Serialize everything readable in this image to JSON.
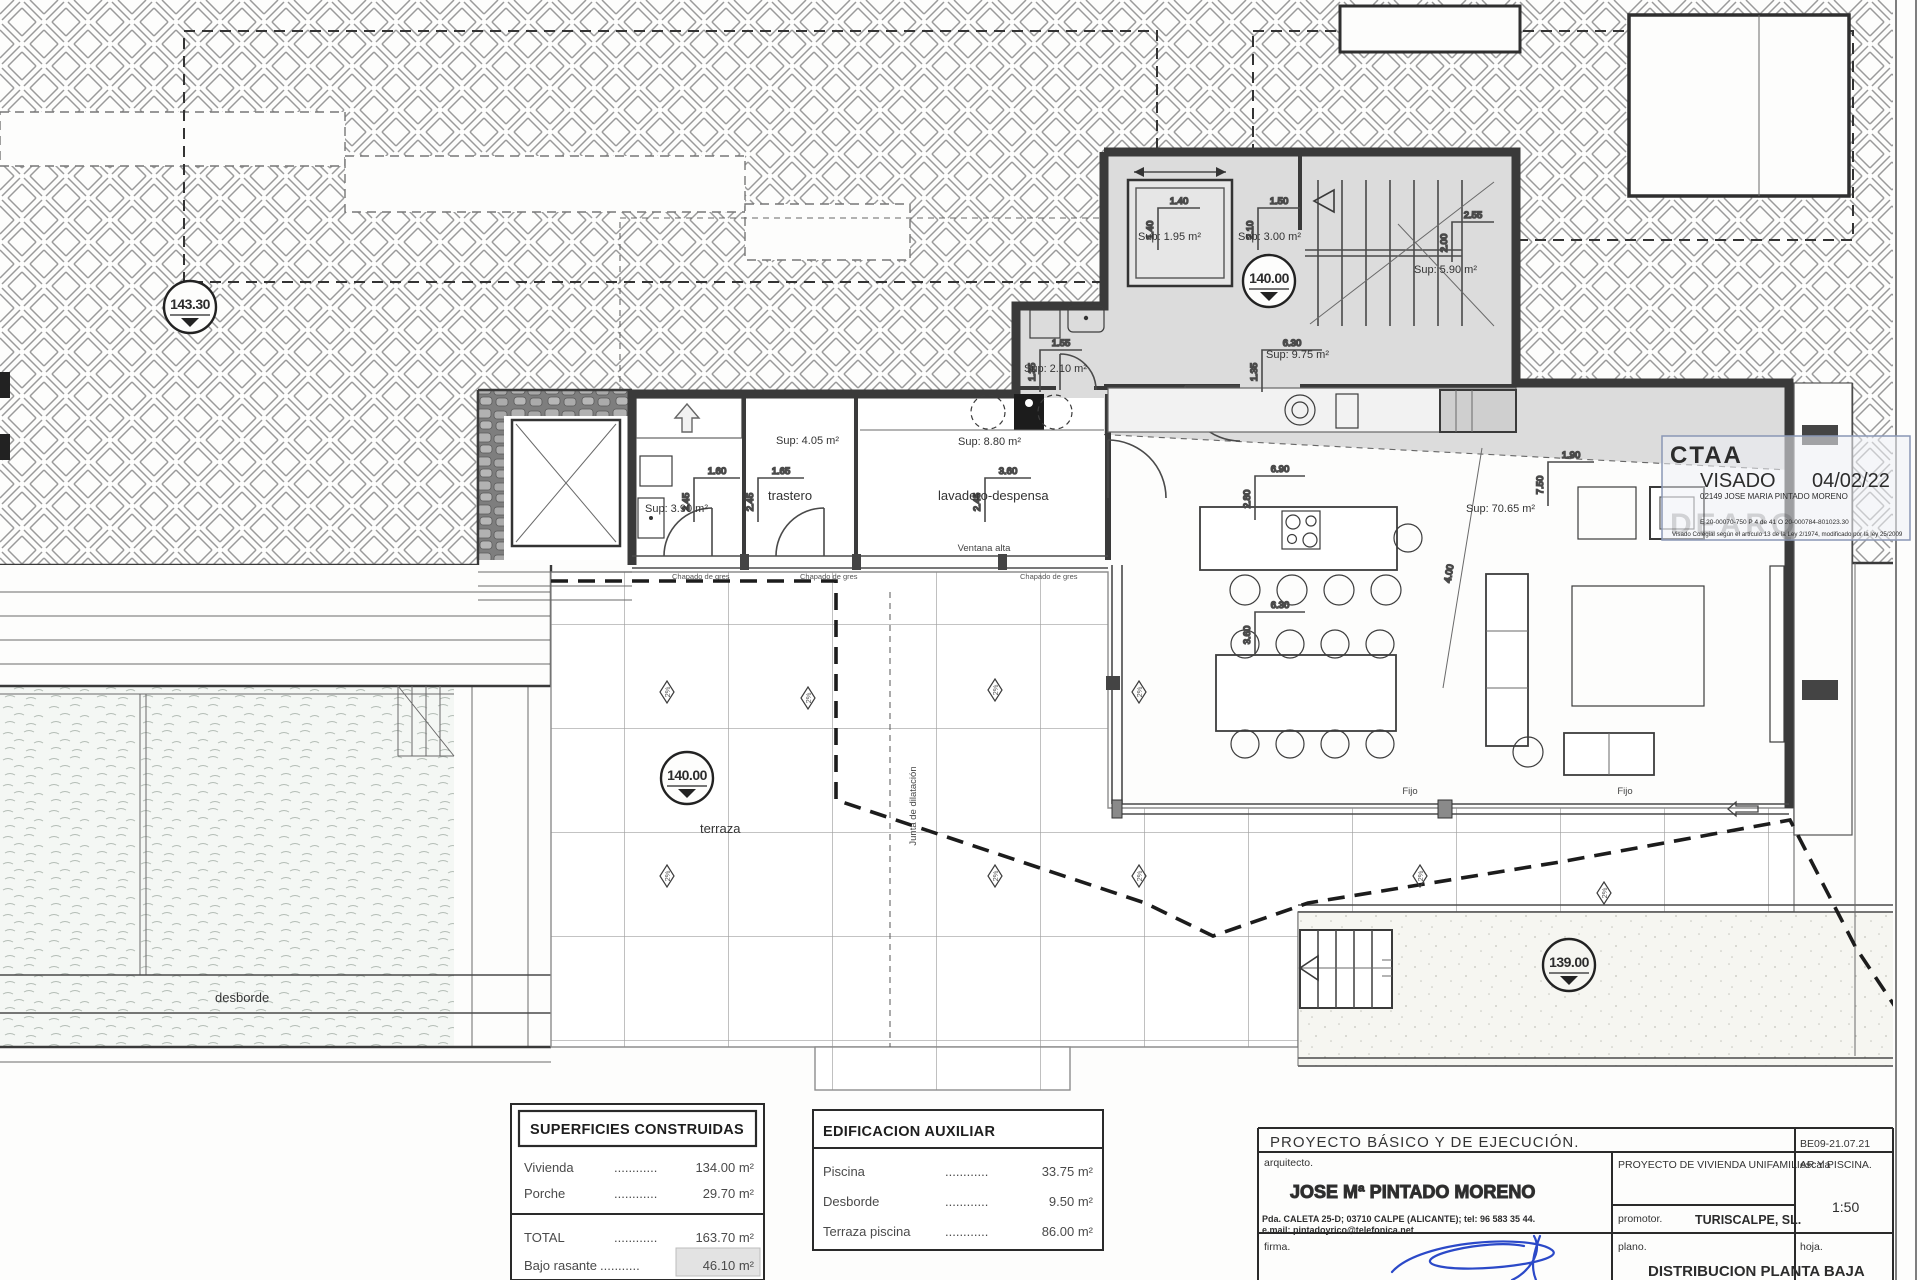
{
  "colors": {
    "accent_blue": "#3a5fa8",
    "signature_blue": "#2b49c8",
    "wall_dark": "#3a3a3a",
    "shade_gray": "#dcdcdc"
  },
  "levels": {
    "upper": "143.30",
    "main": "140.00",
    "lower": "139.00"
  },
  "sups": {
    "bath": "Sup: 3.90 m²",
    "trastero": "Sup: 4.05 m²",
    "lavadero": "Sup: 8.80 m²",
    "aseo": "Sup: 2.10 m²",
    "ascensor": "Sup: 1.95 m²",
    "vestibulo": "Sup: 3.00 m²",
    "escalera": "Sup: 5.90 m²",
    "pasillo": "Sup: 9.75 m²",
    "salon": "Sup: 70.65 m²"
  },
  "dims": {
    "v160": "1.60",
    "v165": "1.65",
    "v360": "3.60",
    "v245": "2.45",
    "v155": "1.55",
    "v135": "1.35",
    "v140": "1.40",
    "v150": "1.50",
    "v210": "2.10",
    "v255": "2.55",
    "v200": "2.00",
    "v630": "6.30",
    "v690": "6.90",
    "v280": "2.80",
    "v190": "1.90",
    "v750": "7.50",
    "v400": "4.00"
  },
  "labels": {
    "trastero": "trastero",
    "lavadero": "lavadero-despensa",
    "terraza": "terraza",
    "desborde": "desborde",
    "ventana_alta": "Ventana alta",
    "chapado": "Chapado de gres",
    "fijo": "Fijo",
    "junta": "Junta de dilatación",
    "slope": "2%"
  },
  "tables": {
    "superficies": {
      "title": "SUPERFICIES CONSTRUIDAS",
      "rows": [
        {
          "label": "Vivienda",
          "dots": "............",
          "value": "134.00 m²"
        },
        {
          "label": "Porche",
          "dots": "............",
          "value": "29.70 m²"
        }
      ],
      "total": {
        "label": "TOTAL",
        "dots": "............",
        "value": "163.70 m²"
      },
      "bajo": {
        "label": "Bajo rasante",
        "dots": "...........",
        "value": "46.10 m²"
      }
    },
    "auxiliar": {
      "title": "EDIFICACION AUXILIAR",
      "rows": [
        {
          "label": "Piscina",
          "dots": "............",
          "value": "33.75 m²"
        },
        {
          "label": "Desborde",
          "dots": "............",
          "value": "9.50 m²"
        },
        {
          "label": "Terraza piscina",
          "dots": "............",
          "value": "86.00 m²"
        }
      ]
    }
  },
  "titleblock": {
    "project": "PROYECTO  BÁSICO  Y  DE  EJECUCIÓN.",
    "code": "BE09-21.07.21",
    "arquitecto_label": "arquitecto.",
    "arquitecto": "JOSE Mª PINTADO MORENO",
    "address": "Pda. CALETA 25-D; 03710 CALPE (ALICANTE); tel: 96 583 35 44.",
    "email": "e.mail: pintadoyrico@telefonica.net",
    "proyecto": "PROYECTO  DE  VIVIENDA  UNIFAMILIAR  Y  PISCINA.",
    "promotor_label": "promotor.",
    "promotor": "TURISCALPE, SL.",
    "escala_label": "escala",
    "escala": "1:50",
    "firma_label": "firma.",
    "plano_label": "plano.",
    "plano": "DISTRIBUCION  PLANTA  BAJA",
    "hoja_label": "hoja."
  },
  "stamp": {
    "org": "CTAA",
    "visado": "VISADO",
    "date": "04/02/22",
    "colegiado": "02149 JOSE MARIA PINTADO MORENO",
    "ref_line": "E 20-00070-750      P 4 de 41      O 20-000784-801023.30",
    "legal_line": "Visado Colegial según el artículo 13 de la Ley 2/1974, modificado por la ley 25/2009",
    "watermark": "DEARQ"
  }
}
